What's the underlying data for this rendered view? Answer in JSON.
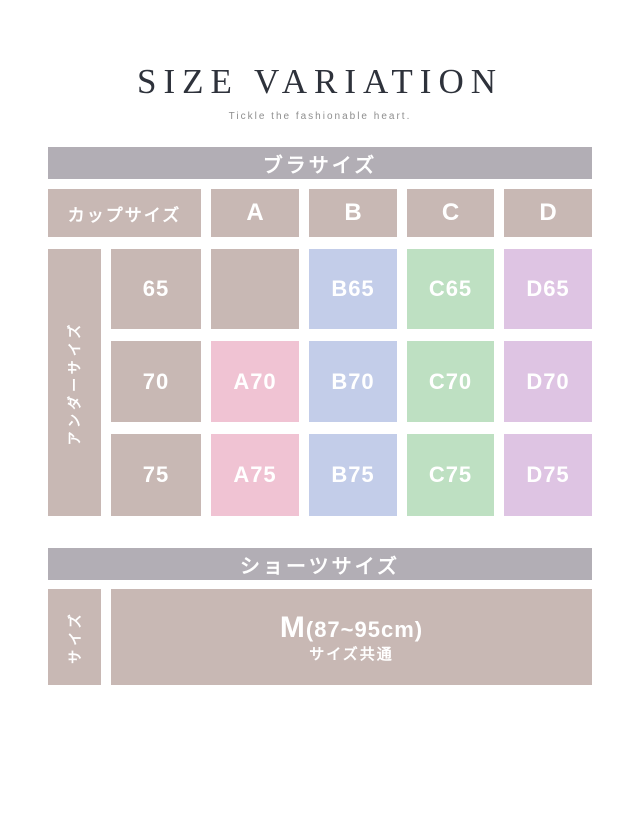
{
  "page": {
    "title": "SIZE VARIATION",
    "subtitle": "Tickle the fashionable heart."
  },
  "colors": {
    "header_bar": "#b2aeb5",
    "taupe": "#c8b8b4",
    "pink": "#f0c3d3",
    "blue": "#c3cde9",
    "green": "#bee0c2",
    "purple": "#dec4e3"
  },
  "bra_table": {
    "section_title": "ブラサイズ",
    "col_axis_label": "カップサイズ",
    "row_axis_label": "アンダーサイズ",
    "cup_columns": [
      "A",
      "B",
      "C",
      "D"
    ],
    "rows": [
      {
        "under": "65",
        "a": "",
        "b": "B65",
        "c": "C65",
        "d": "D65"
      },
      {
        "under": "70",
        "a": "A70",
        "b": "B70",
        "c": "C70",
        "d": "D70"
      },
      {
        "under": "75",
        "a": "A75",
        "b": "B75",
        "c": "C75",
        "d": "D75"
      }
    ]
  },
  "shorts_table": {
    "section_title": "ショーツサイズ",
    "row_axis_label": "サイズ",
    "size_value": "M",
    "size_range": "(87~95cm)",
    "size_note": "サイズ共通"
  },
  "chart_data": [
    {
      "type": "table",
      "title": "ブラサイズ",
      "row_axis_label": "アンダーサイズ",
      "col_axis_label": "カップサイズ",
      "columns": [
        "A",
        "B",
        "C",
        "D"
      ],
      "rows": [
        "65",
        "70",
        "75"
      ],
      "cells": [
        [
          "",
          "B65",
          "C65",
          "D65"
        ],
        [
          "A70",
          "B70",
          "C70",
          "D70"
        ],
        [
          "A75",
          "B75",
          "C75",
          "D75"
        ]
      ]
    },
    {
      "type": "table",
      "title": "ショーツサイズ",
      "row_axis_label": "サイズ",
      "rows": [
        "サイズ"
      ],
      "cells": [
        [
          "M(87~95cm) サイズ共通"
        ]
      ]
    }
  ]
}
